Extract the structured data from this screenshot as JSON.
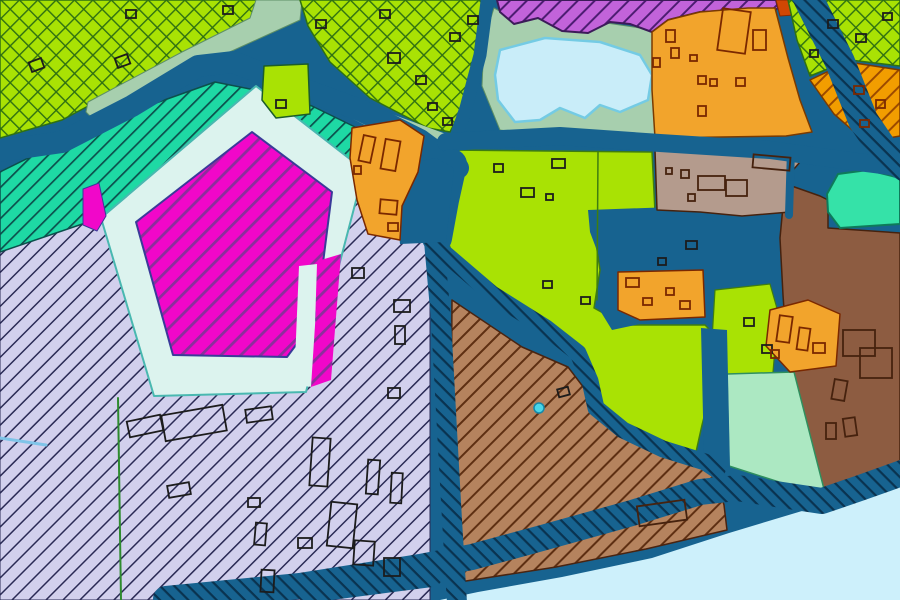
{
  "canvas": {
    "width": 900,
    "height": 600
  },
  "palette": {
    "roadBlue": "#176390",
    "lime": "#a9e204",
    "sage": "#a7cfae",
    "lakeBlue": "#c9edf9",
    "lakeEdge": "#74cbe4",
    "paleRing": "#dcf3ee",
    "water": "#cdf0fb",
    "amber": "#f2a42c",
    "taupe": "#b49b8d",
    "brown": "#8d5c41",
    "mint": "#ace8c2",
    "turquoise": "#35e2a8",
    "magenta": "#f107c9",
    "redOrange": "#d14703",
    "cyanDot": "#49d6e8",
    "bk": "#1c1c1c",
    "br": "#7a2800",
    "bb": "#46220e"
  },
  "patterns": [
    {
      "id": "limex",
      "bg": "#a9e204",
      "line": "#2f7012",
      "sp": 13,
      "lw": 1.4,
      "rot": -45,
      "cross": true
    },
    {
      "id": "tealh",
      "bg": "#1ed9a4",
      "line": "#0c4f4c",
      "sp": 11,
      "lw": 1.7,
      "rot": -45,
      "cross": false
    },
    {
      "id": "purph",
      "bg": "#c263da",
      "line": "#4d1d72",
      "sp": 12,
      "lw": 2.0,
      "rot": -45,
      "cross": false
    },
    {
      "id": "magh",
      "bg": "#f107c9",
      "line": "#8c2e9c",
      "sp": 14,
      "lw": 2.8,
      "rot": -45,
      "cross": false
    },
    {
      "id": "lavh",
      "bg": "#d2d0ed",
      "line": "#2a2a55",
      "sp": 12,
      "lw": 1.5,
      "rot": -45,
      "cross": false
    },
    {
      "id": "brnh",
      "bg": "#b5835e",
      "line": "#5e2f12",
      "sp": 12,
      "lw": 2.0,
      "rot": -45,
      "cross": false
    },
    {
      "id": "orgh",
      "bg": "#f29d00",
      "line": "#9c4a00",
      "sp": 12,
      "lw": 2.0,
      "rot": -45,
      "cross": false
    },
    {
      "id": "roadh",
      "bg": "#176390",
      "line": "#0a3350",
      "sp": 10,
      "lw": 2.2,
      "rot": 45,
      "cross": false
    }
  ],
  "shapes": [
    {
      "n": "base-water",
      "t": "poly",
      "p": "0,0 900,0 900,600 0,600",
      "f": "roadBlue"
    },
    {
      "n": "region-lavender-south",
      "t": "poly",
      "p": "0,240 370,155 430,230 430,600 0,600",
      "f": "lavh",
      "s": "#2a2a55",
      "w": 1
    },
    {
      "n": "region-teal-band",
      "t": "poly",
      "p": "0,172 95,125 170,98 215,82 265,92 312,106 355,127 378,150 372,168 340,178 240,200 100,218 0,252",
      "f": "tealh",
      "s": "#0c4f4c",
      "w": 1.5
    },
    {
      "n": "region-lime-northwest",
      "t": "poly",
      "p": "0,0 258,0 252,20 160,72 92,104 62,120 0,138",
      "f": "limex",
      "s": "#2f7012",
      "w": 1.5
    },
    {
      "n": "region-sage-strip",
      "t": "poly",
      "p": "88,102 182,52 250,18 256,0 302,0 300,20 212,60 130,106 96,122 86,112",
      "f": "sage",
      "s": "#5d8f66",
      "w": 1
    },
    {
      "n": "region-lime-north-center",
      "t": "poly",
      "p": "300,0 487,0 482,40 466,100 450,132 428,128 370,98 330,62 308,26",
      "f": "limex",
      "s": "#2f7012",
      "w": 1.5
    },
    {
      "n": "region-sage-wedge",
      "t": "poly",
      "p": "348,98 446,134 450,152 380,133 344,114",
      "f": "sage"
    },
    {
      "n": "region-sage-lakeside",
      "t": "poly",
      "p": "494,8 520,22 548,16 578,28 600,22 640,28 656,34 656,140 610,136 540,136 500,130 482,86 484,40",
      "f": "sage",
      "s": "#5d8f66",
      "w": 1
    },
    {
      "n": "waterbody-lake",
      "t": "poly",
      "p": "500,50 545,38 600,42 640,55 652,75 648,100 620,112 600,105 585,118 560,108 540,120 515,122 498,100 495,75",
      "f": "lakeBlue",
      "s": "#74cbe4",
      "w": 2.5
    },
    {
      "n": "region-purple-north",
      "t": "poly",
      "p": "497,0 776,0 778,8 770,14 740,10 700,12 668,20 652,32 630,24 610,22 588,33 562,31 538,18 514,24 500,12",
      "f": "purph",
      "s": "#3c1b59",
      "w": 2
    },
    {
      "n": "region-redorange-patch",
      "t": "poly",
      "p": "776,0 816,0 808,14 780,16",
      "f": "redOrange",
      "s": "#8a2a00",
      "w": 1
    },
    {
      "n": "region-lime-northeast",
      "t": "poly",
      "p": "788,0 900,0 900,66 850,60 810,76 797,40",
      "f": "limex",
      "s": "#2f7012",
      "w": 1.5
    },
    {
      "n": "region-orange-hatched-ne",
      "t": "poly",
      "p": "810,80 848,62 900,70 900,136 866,142 834,114",
      "f": "orgh",
      "s": "#7a3a00",
      "w": 1.5
    },
    {
      "n": "region-orange-north",
      "t": "poly",
      "p": "652,32 668,20 700,12 748,8 775,8 788,58 800,100 812,132 786,136 655,138 652,90",
      "f": "amber",
      "s": "#7a3a00",
      "w": 1.5
    },
    {
      "n": "region-lime-central",
      "t": "poly",
      "p": "447,150 652,152 655,212 592,216 600,270 594,308 625,325 705,325 718,338 714,378 702,425 696,452 660,444 622,428 598,408 590,382 576,356 536,328 492,296 454,260 447,238",
      "f": "lime",
      "s": "#3f7d10",
      "w": 1.5
    },
    {
      "n": "channel-lagoon",
      "t": "poly",
      "p": "588,210 700,206 714,222 788,222 788,302 770,307 744,300 722,287 700,312 640,324 612,330 596,304 602,264 590,232",
      "f": "roadBlue"
    },
    {
      "n": "region-lime-column",
      "t": "poly",
      "p": "715,290 770,284 778,312 772,384 742,390 718,382 712,340",
      "f": "lime",
      "s": "#3f7d10",
      "w": 1.2
    },
    {
      "n": "region-brown-east",
      "t": "poly",
      "p": "786,184 820,196 828,200 828,228 900,233 900,468 858,487 824,498 810,468 798,420 788,368 783,295 780,238 783,206",
      "f": "brown",
      "s": "#46220e",
      "w": 1.5
    },
    {
      "n": "region-turquoise",
      "t": "poly",
      "p": "827,194 838,174 868,170 900,178 900,224 840,228 828,212",
      "f": "turquoise",
      "s": "#0e7a5a",
      "w": 2
    },
    {
      "n": "region-taupe",
      "t": "poly",
      "p": "655,150 758,148 762,156 800,162 788,176 790,212 742,216 700,212 657,210",
      "f": "taupe",
      "s": "#46220e",
      "w": 1.5
    },
    {
      "n": "channel-taupe-east",
      "t": "line",
      "p": "791,150 789,215",
      "s": "#176390",
      "w": 8
    },
    {
      "n": "region-mint",
      "t": "poly",
      "p": "727,374 794,372 826,497 729,466",
      "f": "mint",
      "s": "#2f8f5e",
      "w": 1.5
    },
    {
      "n": "region-brown-hatched-south",
      "t": "poly",
      "p": "452,300 522,347 568,367 584,388 590,410 616,432 655,450 700,464 714,470 724,505 727,530 646,549 556,567 466,581 450,585",
      "f": "brnh",
      "s": "#4a2410",
      "w": 1.5
    },
    {
      "n": "waterbody-south",
      "t": "poly",
      "p": "440,600 478,592 562,577 652,558 729,533 802,511 855,493 886,478 900,471 900,600",
      "f": "water"
    },
    {
      "n": "channel-mint-west",
      "t": "poly",
      "p": "701,328 727,330 730,468 704,460",
      "f": "roadBlue"
    },
    {
      "n": "road-northwest",
      "t": "path",
      "p": "-8,152 62,142 132,106 198,66 233,62 300,88 360,110 420,140 458,168",
      "sp": "roadBlue",
      "w": 22
    },
    {
      "n": "road-north",
      "t": "path",
      "p": "488,-6 480,55 466,108 455,140 450,166",
      "sp": "roadBlue",
      "w": 13
    },
    {
      "n": "road-east-west",
      "t": "path",
      "p": "446,142 560,136 660,143 770,150 850,161 906,168",
      "sp": "roadBlue",
      "w": 18
    },
    {
      "n": "road-junction-south",
      "t": "path",
      "p": "452,164 444,200 437,238",
      "sp": "roadBlue",
      "w": 30
    },
    {
      "n": "road-hatched-northeast",
      "t": "path",
      "p": "806,-6 840,62 863,120 886,154 906,167",
      "sp": "roadh",
      "w": 30
    },
    {
      "n": "road-hatched-central",
      "t": "path",
      "p": "433,230 441,320 447,430 452,520 457,603",
      "sp": "roadh",
      "w": 20
    },
    {
      "n": "road-hatched-diagonal",
      "t": "path",
      "p": "436,246 492,294 546,328 578,353 590,381 596,408 623,430 663,449 705,462 717,470",
      "sp": "roadh",
      "w": 17
    },
    {
      "n": "road-hatched-shore",
      "t": "path",
      "p": "166,599 300,586 420,567 472,557 542,538 632,513 700,492 737,488 782,495 822,501 860,488 902,473",
      "sp": "roadh",
      "w": 26
    },
    {
      "n": "road-hatched-shore-spur",
      "t": "path",
      "p": "308,593 432,577",
      "sp": "roadh",
      "w": 20
    },
    {
      "n": "junction-patch",
      "t": "poly",
      "p": "396,166 436,158 454,168 446,242 400,244 396,205",
      "f": "roadBlue"
    },
    {
      "n": "region-orange-block-1",
      "t": "poly",
      "p": "618,272 703,270 705,317 640,320 618,310",
      "f": "amber",
      "s": "#7a2800",
      "w": 1.5
    },
    {
      "n": "region-orange-block-2",
      "t": "poly",
      "p": "770,310 808,300 840,314 836,366 790,372 766,346",
      "f": "amber",
      "s": "#7a2800",
      "w": 1.5
    },
    {
      "n": "pentagon-ring",
      "t": "poly",
      "p": "256,86 364,170 306,392 154,396 101,218",
      "f": "paleRing",
      "s": "#49b8b0",
      "w": 2
    },
    {
      "n": "pentagon-magenta",
      "t": "poly",
      "p": "252,132 332,192 316,318 287,357 173,355 136,222",
      "f": "magh",
      "s": "#3a3a99",
      "w": 2
    },
    {
      "n": "pentagon-finger",
      "t": "poly",
      "p": "299,266 317,264 313,387 294,385",
      "f": "paleRing"
    },
    {
      "n": "magenta-sliver",
      "t": "poly",
      "p": "321,260 341,254 331,380 311,387 316,310",
      "f": "magh"
    },
    {
      "n": "magenta-blob",
      "t": "poly",
      "p": "83,189 99,183 106,216 97,231 83,225",
      "f": "magenta",
      "s": "#3a3a99",
      "w": 1
    },
    {
      "n": "region-orange-west",
      "t": "poly",
      "p": "352,128 400,120 424,136 418,172 402,206 400,240 368,234 357,200 350,158",
      "f": "amber",
      "s": "#7a2800",
      "w": 1.5
    },
    {
      "n": "parcel-lime-in-teal",
      "t": "poly",
      "p": "264,66 308,64 310,114 276,118 262,100",
      "f": "lime",
      "s": "#1c5c2a",
      "w": 1.5
    },
    {
      "n": "parcel-line-green",
      "t": "line",
      "p": "118,398 121,600",
      "s": "#2e8b2e",
      "w": 2
    },
    {
      "n": "parcel-line-lime",
      "t": "line",
      "p": "598,152 597,300",
      "s": "#3f7d10",
      "w": 1.5
    },
    {
      "n": "waterline-west",
      "t": "line",
      "p": "0,438 46,445",
      "s": "#7fc4e8",
      "w": 3
    },
    {
      "n": "cyan-dot",
      "t": "circle",
      "cx": 539,
      "cy": 408,
      "r": 5,
      "f": "cyanDot",
      "s": "#1888a8",
      "w": 1.5
    }
  ],
  "buildings": [
    [
      128,
      418,
      34,
      16,
      -12,
      "bk"
    ],
    [
      163,
      410,
      62,
      26,
      -10,
      "bk"
    ],
    [
      246,
      408,
      26,
      13,
      -8,
      "bk"
    ],
    [
      168,
      484,
      22,
      12,
      -10,
      "bk"
    ],
    [
      248,
      498,
      12,
      9,
      0,
      "bk"
    ],
    [
      255,
      523,
      11,
      22,
      5,
      "bk"
    ],
    [
      261,
      570,
      13,
      22,
      3,
      "bk"
    ],
    [
      298,
      538,
      14,
      10,
      0,
      "bk"
    ],
    [
      311,
      438,
      18,
      48,
      4,
      "bk"
    ],
    [
      329,
      503,
      26,
      44,
      6,
      "bk"
    ],
    [
      354,
      541,
      20,
      24,
      4,
      "bk"
    ],
    [
      367,
      460,
      12,
      34,
      4,
      "bk"
    ],
    [
      391,
      473,
      11,
      30,
      3,
      "bk"
    ],
    [
      384,
      558,
      16,
      18,
      0,
      "bk"
    ],
    [
      394,
      300,
      16,
      12,
      0,
      "bk"
    ],
    [
      395,
      326,
      10,
      18,
      0,
      "bk"
    ],
    [
      352,
      268,
      12,
      10,
      0,
      "bk"
    ],
    [
      388,
      388,
      12,
      10,
      0,
      "bk"
    ],
    [
      30,
      60,
      13,
      10,
      -20,
      "bk"
    ],
    [
      116,
      56,
      13,
      10,
      -20,
      "bk"
    ],
    [
      126,
      10,
      10,
      8,
      0,
      "bk"
    ],
    [
      223,
      6,
      10,
      8,
      0,
      "bk"
    ],
    [
      316,
      20,
      10,
      8,
      0,
      "bk"
    ],
    [
      380,
      10,
      10,
      8,
      0,
      "bk"
    ],
    [
      388,
      53,
      12,
      10,
      0,
      "bk"
    ],
    [
      416,
      76,
      10,
      8,
      0,
      "bk"
    ],
    [
      450,
      33,
      10,
      8,
      0,
      "bk"
    ],
    [
      468,
      16,
      10,
      8,
      0,
      "bk"
    ],
    [
      428,
      103,
      9,
      7,
      0,
      "bk"
    ],
    [
      443,
      118,
      9,
      7,
      0,
      "bk"
    ],
    [
      276,
      100,
      10,
      8,
      0,
      "bk"
    ],
    [
      494,
      164,
      9,
      8,
      0,
      "bk"
    ],
    [
      521,
      188,
      13,
      9,
      0,
      "bk"
    ],
    [
      546,
      194,
      7,
      6,
      0,
      "bk"
    ],
    [
      552,
      159,
      13,
      9,
      0,
      "bk"
    ],
    [
      543,
      281,
      9,
      7,
      0,
      "bk"
    ],
    [
      581,
      297,
      9,
      7,
      0,
      "bk"
    ],
    [
      558,
      388,
      11,
      8,
      -15,
      "bk"
    ],
    [
      686,
      241,
      11,
      8,
      0,
      "bk"
    ],
    [
      658,
      258,
      8,
      7,
      0,
      "bk"
    ],
    [
      744,
      318,
      10,
      8,
      0,
      "bk"
    ],
    [
      762,
      345,
      10,
      8,
      0,
      "bk"
    ],
    [
      828,
      20,
      10,
      8,
      0,
      "bk"
    ],
    [
      856,
      34,
      10,
      8,
      0,
      "bk"
    ],
    [
      883,
      13,
      9,
      7,
      0,
      "bk"
    ],
    [
      810,
      50,
      8,
      7,
      0,
      "bk"
    ],
    [
      854,
      86,
      10,
      8,
      0,
      "br"
    ],
    [
      876,
      100,
      9,
      8,
      0,
      "br"
    ],
    [
      860,
      120,
      9,
      7,
      0,
      "br"
    ],
    [
      720,
      10,
      28,
      42,
      8,
      "br"
    ],
    [
      753,
      30,
      13,
      20,
      0,
      "br"
    ],
    [
      666,
      30,
      9,
      12,
      0,
      "br"
    ],
    [
      671,
      48,
      8,
      10,
      0,
      "br"
    ],
    [
      653,
      58,
      7,
      9,
      0,
      "br"
    ],
    [
      698,
      76,
      8,
      8,
      0,
      "br"
    ],
    [
      710,
      79,
      7,
      7,
      0,
      "br"
    ],
    [
      736,
      78,
      9,
      8,
      0,
      "br"
    ],
    [
      698,
      106,
      8,
      10,
      0,
      "br"
    ],
    [
      690,
      55,
      7,
      6,
      0,
      "br"
    ],
    [
      361,
      136,
      12,
      26,
      12,
      "br"
    ],
    [
      383,
      140,
      15,
      30,
      10,
      "br"
    ],
    [
      380,
      200,
      17,
      14,
      5,
      "br"
    ],
    [
      354,
      166,
      7,
      8,
      0,
      "br"
    ],
    [
      388,
      223,
      10,
      8,
      0,
      "br"
    ],
    [
      626,
      278,
      13,
      9,
      0,
      "br"
    ],
    [
      643,
      298,
      9,
      7,
      0,
      "br"
    ],
    [
      666,
      288,
      8,
      7,
      0,
      "br"
    ],
    [
      680,
      301,
      10,
      8,
      0,
      "br"
    ],
    [
      778,
      316,
      13,
      26,
      8,
      "br"
    ],
    [
      798,
      328,
      11,
      22,
      8,
      "br"
    ],
    [
      813,
      343,
      12,
      10,
      0,
      "br"
    ],
    [
      771,
      350,
      8,
      8,
      0,
      "br"
    ],
    [
      698,
      176,
      27,
      14,
      0,
      "bb"
    ],
    [
      726,
      180,
      21,
      16,
      0,
      "bb"
    ],
    [
      681,
      170,
      8,
      8,
      0,
      "bb"
    ],
    [
      688,
      194,
      7,
      7,
      0,
      "bb"
    ],
    [
      666,
      168,
      6,
      6,
      0,
      "bb"
    ],
    [
      753,
      156,
      37,
      13,
      5,
      "bb"
    ],
    [
      833,
      380,
      13,
      20,
      10,
      "bb"
    ],
    [
      826,
      423,
      10,
      16,
      0,
      "bb"
    ],
    [
      844,
      418,
      12,
      18,
      -8,
      "bb"
    ],
    [
      843,
      330,
      32,
      26,
      0,
      "bb"
    ],
    [
      860,
      348,
      32,
      30,
      0,
      "bb"
    ],
    [
      638,
      503,
      48,
      20,
      -8,
      "bb"
    ]
  ]
}
